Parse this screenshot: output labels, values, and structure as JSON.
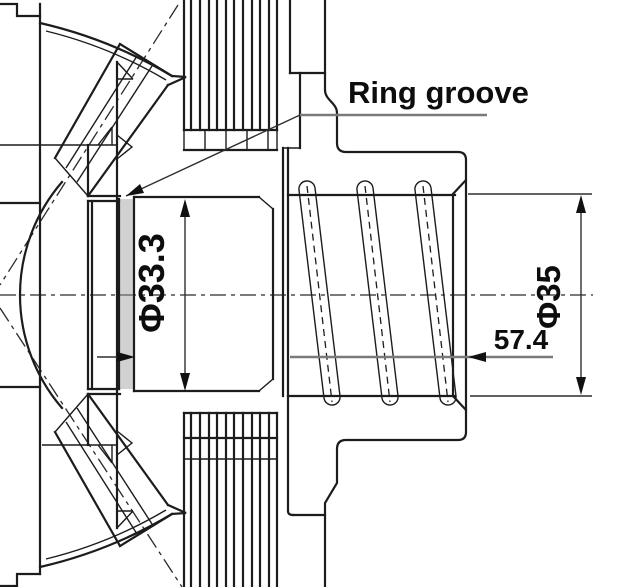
{
  "drawing": {
    "title": "Differential case hub cross-section",
    "labels": {
      "ring_groove": "Ring groove",
      "inner_diameter": "Φ33.3",
      "outer_diameter": "Φ35",
      "length": "57.4"
    },
    "dimensions": [
      {
        "name": "inner-diameter",
        "text": "Φ33.3",
        "value": 33.3,
        "orientation": "vertical-rotated"
      },
      {
        "name": "outer-diameter",
        "text": "Φ35",
        "value": 35,
        "orientation": "vertical-rotated"
      },
      {
        "name": "hub-length",
        "text": "57.4",
        "value": 57.4,
        "orientation": "horizontal"
      }
    ],
    "callouts": [
      {
        "name": "ring-groove",
        "text": "Ring groove",
        "leader": "arrow points to groove on hub bore"
      }
    ],
    "colors": {
      "ink": "#1c1c1c",
      "dimension_gray": "#7a7a7a",
      "background": "#ffffff"
    }
  }
}
